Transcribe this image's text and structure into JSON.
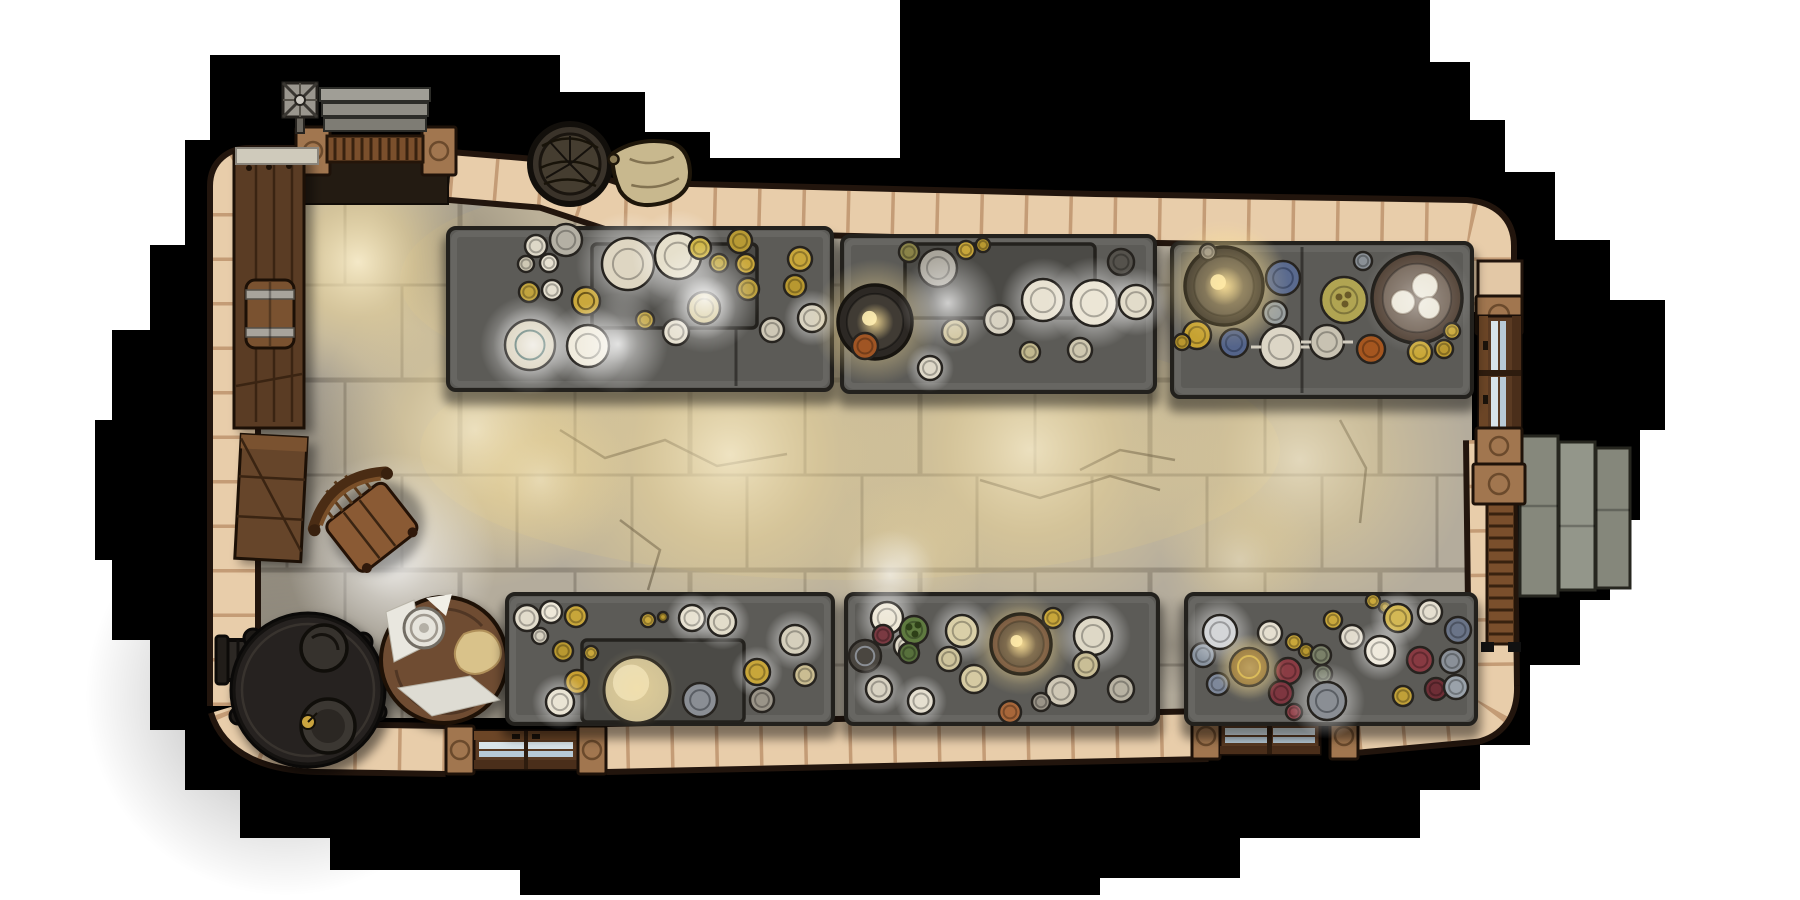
{
  "scene": {
    "description": "Top-down fantasy battle map of a stone feast hall kitchen: six laden stone banquet tables, iron stove, round prep table, barrels, crates, baskets, stone stairs and three doorways, surrounded by a black pixel-stepped void",
    "canvas": {
      "width": 1800,
      "height": 900,
      "background": "#ffffff"
    },
    "palette": {
      "void": "#000000",
      "wall": "#e8cdaa",
      "wall_outline": "#22150d",
      "wall_seam": "rgba(160,108,66,0.5)",
      "floor": "#b4ac9c",
      "table": "#5c5b57",
      "table_inner": "#4b4a46",
      "table_outline": "#23211d",
      "wood": "#7a4f2c",
      "metal": "#8a8c80"
    },
    "objects": [
      "banquet-table-nw",
      "banquet-table-n",
      "banquet-table-ne",
      "banquet-table-sw",
      "banquet-table-s",
      "banquet-table-se",
      "iron-stove",
      "round-prep-table",
      "wooden-chair",
      "wooden-crate",
      "barrel",
      "wall-shelf",
      "storage-basket",
      "grain-sack",
      "entrance-steps",
      "weather-vane",
      "right-door",
      "right-ladder",
      "right-platform",
      "bottom-door-west",
      "bottom-door-east"
    ]
  },
  "props": {
    "weather-vane": {
      "x": 300,
      "y": 100,
      "rot": 0
    },
    "entrance-steps": {
      "x": 375,
      "y": 110,
      "rot": 0
    },
    "storage-basket": {
      "x": 570,
      "y": 164,
      "rot": 0
    },
    "grain-sack": {
      "x": 652,
      "y": 174,
      "rot": -8
    },
    "wall-shelf": {
      "x": 269,
      "y": 288,
      "rot": 0
    },
    "barrel": {
      "x": 270,
      "y": 314,
      "rot": 0
    },
    "wooden-crate": {
      "x": 271,
      "y": 498,
      "rot": 3
    },
    "chair": {
      "x": 368,
      "y": 524,
      "rot": -38
    },
    "stove": {
      "x": 308,
      "y": 690,
      "rot": 0
    },
    "prep-table-round": {
      "x": 444,
      "y": 660,
      "rot": 0
    },
    "right-door": {
      "x": 1500,
      "y": 373,
      "rot": 0
    },
    "right-ladder": {
      "x": 1501,
      "y": 574,
      "rot": 0
    },
    "right-platform": {
      "x": 1575,
      "y": 516,
      "rot": 0
    },
    "bottom-door-west": {
      "x": 526,
      "y": 750,
      "rot": 0
    },
    "bottom-door-east": {
      "x": 1270,
      "y": 735,
      "rot": 0
    }
  },
  "lights": [
    {
      "x": 358,
      "y": 262,
      "r": 125,
      "kind": "warm",
      "o": 0.9,
      "layer": "floor"
    },
    {
      "x": 475,
      "y": 430,
      "r": 160,
      "kind": "warm",
      "o": 0.75,
      "layer": "floor"
    },
    {
      "x": 730,
      "y": 455,
      "r": 200,
      "kind": "warm",
      "o": 0.8,
      "layer": "floor"
    },
    {
      "x": 1030,
      "y": 450,
      "r": 190,
      "kind": "warm",
      "o": 0.75,
      "layer": "floor"
    },
    {
      "x": 1300,
      "y": 460,
      "r": 170,
      "kind": "warm",
      "o": 0.65,
      "layer": "floor"
    },
    {
      "x": 540,
      "y": 480,
      "r": 90,
      "kind": "warm",
      "o": 0.5,
      "layer": "floor"
    },
    {
      "x": 620,
      "y": 300,
      "r": 90,
      "kind": "white",
      "o": 0.5,
      "layer": "floor"
    },
    {
      "x": 905,
      "y": 560,
      "r": 80,
      "kind": "warm",
      "o": 0.45,
      "layer": "floor"
    },
    {
      "x": 1240,
      "y": 560,
      "r": 80,
      "kind": "warm",
      "o": 0.4,
      "layer": "floor"
    },
    {
      "x": 392,
      "y": 558,
      "r": 105,
      "kind": "white",
      "o": 0.85,
      "layer": "floor"
    },
    {
      "x": 705,
      "y": 298,
      "r": 55,
      "kind": "white",
      "o": 0.85,
      "layer": "top"
    },
    {
      "x": 948,
      "y": 303,
      "r": 50,
      "kind": "white",
      "o": 0.75,
      "layer": "top"
    },
    {
      "x": 618,
      "y": 344,
      "r": 50,
      "kind": "white",
      "o": 0.8,
      "layer": "top"
    },
    {
      "x": 533,
      "y": 345,
      "r": 40,
      "kind": "white",
      "o": 0.7,
      "layer": "top"
    },
    {
      "x": 890,
      "y": 575,
      "r": 45,
      "kind": "white",
      "o": 0.6,
      "layer": "top"
    },
    {
      "x": 1229,
      "y": 287,
      "r": 60,
      "kind": "gold",
      "o": 0.6,
      "layer": "top"
    },
    {
      "x": 1418,
      "y": 300,
      "r": 55,
      "kind": "white",
      "o": 0.45,
      "layer": "top"
    },
    {
      "x": 637,
      "y": 688,
      "r": 40,
      "kind": "gold",
      "o": 0.4,
      "layer": "top"
    },
    {
      "x": 1022,
      "y": 645,
      "r": 40,
      "kind": "gold",
      "o": 0.5,
      "layer": "top"
    },
    {
      "x": 1250,
      "y": 668,
      "r": 35,
      "kind": "gold",
      "o": 0.5,
      "layer": "top"
    }
  ],
  "darks": [
    {
      "x": 285,
      "y": 696,
      "r": 200,
      "o": 0.55
    },
    {
      "x": 262,
      "y": 470,
      "r": 150,
      "o": 0.4
    },
    {
      "x": 455,
      "y": 250,
      "r": 90,
      "o": 0.28
    },
    {
      "x": 520,
      "y": 700,
      "r": 80,
      "o": 0.35
    },
    {
      "x": 840,
      "y": 300,
      "r": 55,
      "o": 0.3
    },
    {
      "x": 1165,
      "y": 312,
      "r": 55,
      "o": 0.3
    },
    {
      "x": 1172,
      "y": 645,
      "r": 50,
      "o": 0.3
    }
  ],
  "tables": [
    {
      "id": "banquet-table-nw",
      "x": 448,
      "y": 228,
      "w": 384,
      "h": 162,
      "inner": {
        "x": 592,
        "y": 244,
        "w": 165,
        "h": 84
      },
      "seam": 736,
      "dishes": [
        {
          "x": 536,
          "y": 246,
          "r": 11,
          "f": "#ded8c8"
        },
        {
          "x": 549,
          "y": 263,
          "r": 9,
          "f": "#e8e2d2"
        },
        {
          "x": 526,
          "y": 264,
          "r": 8,
          "f": "#cfc8b4"
        },
        {
          "x": 566,
          "y": 240,
          "r": 16,
          "f": "#b4b0a4"
        },
        {
          "x": 529,
          "y": 292,
          "r": 10,
          "f": "#c2a43e"
        },
        {
          "x": 552,
          "y": 290,
          "r": 10,
          "f": "#e5dfcf"
        },
        {
          "x": 586,
          "y": 301,
          "r": 14,
          "f": "#caa83c",
          "ring": "#6b5618"
        },
        {
          "x": 628,
          "y": 264,
          "r": 26,
          "f": "#ded6c2",
          "glow": 1
        },
        {
          "x": 678,
          "y": 256,
          "r": 23,
          "f": "#e6e0cc",
          "glow": 1
        },
        {
          "x": 530,
          "y": 345,
          "r": 25,
          "f": "#d8d0ba",
          "glow": 1,
          "ring": "#4a6a62"
        },
        {
          "x": 588,
          "y": 346,
          "r": 21,
          "f": "#efeadb",
          "glow": 1
        },
        {
          "x": 645,
          "y": 320,
          "r": 9,
          "f": "#bfa038"
        },
        {
          "x": 676,
          "y": 332,
          "r": 13,
          "f": "#e6e0d0"
        },
        {
          "x": 704,
          "y": 308,
          "r": 16,
          "f": "#cfc089",
          "glow": 1
        },
        {
          "x": 700,
          "y": 248,
          "r": 11,
          "f": "#d2b84a"
        },
        {
          "x": 719,
          "y": 263,
          "r": 9,
          "f": "#c2a83e"
        },
        {
          "x": 740,
          "y": 241,
          "r": 12,
          "f": "#b89a34"
        },
        {
          "x": 746,
          "y": 264,
          "r": 10,
          "f": "#caa83c"
        },
        {
          "x": 748,
          "y": 289,
          "r": 11,
          "f": "#b89a34"
        },
        {
          "x": 800,
          "y": 259,
          "r": 12,
          "f": "#c8a63a"
        },
        {
          "x": 795,
          "y": 286,
          "r": 11,
          "f": "#b89830"
        },
        {
          "x": 812,
          "y": 318,
          "r": 14,
          "f": "#d8d2c0",
          "glow": 1
        },
        {
          "x": 772,
          "y": 330,
          "r": 12,
          "f": "#cfc8b6"
        }
      ]
    },
    {
      "id": "banquet-table-n",
      "x": 842,
      "y": 236,
      "w": 313,
      "h": 156,
      "inner": {
        "x": 905,
        "y": 244,
        "w": 190,
        "h": 74
      },
      "dishes": [
        {
          "x": 938,
          "y": 268,
          "r": 19,
          "f": "#a8a49a"
        },
        {
          "x": 875,
          "y": 322,
          "r": 37,
          "k": "bowl",
          "f": "#403b34",
          "rim": "#2c2824",
          "gw": 1
        },
        {
          "x": 909,
          "y": 252,
          "r": 10,
          "f": "#8a8348"
        },
        {
          "x": 966,
          "y": 250,
          "r": 9,
          "f": "#c8a63a"
        },
        {
          "x": 983,
          "y": 245,
          "r": 7,
          "f": "#b89830"
        },
        {
          "x": 1043,
          "y": 300,
          "r": 21,
          "f": "#e8e2d2",
          "glow": 1
        },
        {
          "x": 1094,
          "y": 303,
          "r": 23,
          "f": "#ece6d6",
          "glow": 1
        },
        {
          "x": 999,
          "y": 320,
          "r": 15,
          "f": "#d8d2c2"
        },
        {
          "x": 955,
          "y": 332,
          "r": 13,
          "f": "#cabd92"
        },
        {
          "x": 1121,
          "y": 262,
          "r": 13,
          "f": "#55524c"
        },
        {
          "x": 1136,
          "y": 302,
          "r": 17,
          "f": "#e2dcca",
          "glow": 1
        },
        {
          "x": 865,
          "y": 346,
          "r": 13,
          "f": "#a05524"
        },
        {
          "x": 930,
          "y": 368,
          "r": 12,
          "f": "#ded8c8",
          "glow": 1
        },
        {
          "x": 1030,
          "y": 352,
          "r": 10,
          "f": "#c2b88e"
        },
        {
          "x": 1080,
          "y": 350,
          "r": 12,
          "f": "#cfc8b0"
        }
      ]
    },
    {
      "id": "banquet-table-ne",
      "x": 1172,
      "y": 243,
      "w": 300,
      "h": 154,
      "seam": 1302,
      "dishes": [
        {
          "x": 1224,
          "y": 286,
          "r": 39,
          "k": "bowl",
          "f": "#4a443c",
          "rim": "#332e28",
          "gw": 1
        },
        {
          "x": 1417,
          "y": 298,
          "r": 45,
          "k": "bowl",
          "f": "#6a5a4c",
          "rim": "#4a392c",
          "buns": 1
        },
        {
          "x": 1283,
          "y": 278,
          "r": 17,
          "f": "#5a6a8e",
          "ring": "#3c4a6a"
        },
        {
          "x": 1234,
          "y": 343,
          "r": 14,
          "f": "#54648a",
          "ring": "#3c4a6a"
        },
        {
          "x": 1275,
          "y": 313,
          "r": 12,
          "f": "#9aa0a0"
        },
        {
          "x": 1363,
          "y": 261,
          "r": 9,
          "f": "#8a9096"
        },
        {
          "x": 1344,
          "y": 300,
          "r": 23,
          "f": "#b0a452",
          "dots": "#6a5a28"
        },
        {
          "x": 1281,
          "y": 347,
          "r": 21,
          "f": "#dcd6c6",
          "cut": 1
        },
        {
          "x": 1327,
          "y": 342,
          "r": 17,
          "f": "#c8c2b2",
          "cut": 1
        },
        {
          "x": 1371,
          "y": 349,
          "r": 14,
          "f": "#a5561f"
        },
        {
          "x": 1197,
          "y": 335,
          "r": 14,
          "f": "#c6a232"
        },
        {
          "x": 1182,
          "y": 342,
          "r": 8,
          "f": "#b8962e"
        },
        {
          "x": 1420,
          "y": 352,
          "r": 12,
          "f": "#caa838"
        },
        {
          "x": 1444,
          "y": 349,
          "r": 9,
          "f": "#ba9830"
        },
        {
          "x": 1452,
          "y": 331,
          "r": 8,
          "f": "#caa838"
        },
        {
          "x": 1208,
          "y": 252,
          "r": 8,
          "f": "#9a9488"
        }
      ]
    },
    {
      "id": "banquet-table-sw",
      "x": 507,
      "y": 594,
      "w": 326,
      "h": 130,
      "inner": {
        "x": 582,
        "y": 640,
        "w": 162,
        "h": 82
      },
      "dishes": [
        {
          "x": 527,
          "y": 618,
          "r": 13,
          "f": "#e2dccc"
        },
        {
          "x": 551,
          "y": 612,
          "r": 11,
          "f": "#eee8d8"
        },
        {
          "x": 540,
          "y": 636,
          "r": 8,
          "f": "#d8d2c2"
        },
        {
          "x": 576,
          "y": 616,
          "r": 11,
          "f": "#c8a63a"
        },
        {
          "x": 563,
          "y": 651,
          "r": 10,
          "f": "#b89830"
        },
        {
          "x": 591,
          "y": 653,
          "r": 7,
          "f": "#caa83c"
        },
        {
          "x": 577,
          "y": 682,
          "r": 12,
          "f": "#c8a032"
        },
        {
          "x": 560,
          "y": 702,
          "r": 14,
          "f": "#eae4d4",
          "glow": 1
        },
        {
          "x": 648,
          "y": 620,
          "r": 7,
          "f": "#caa83c"
        },
        {
          "x": 663,
          "y": 617,
          "r": 5,
          "f": "#b89830"
        },
        {
          "x": 692,
          "y": 618,
          "r": 13,
          "f": "#e8e2d2",
          "glow": 1
        },
        {
          "x": 722,
          "y": 622,
          "r": 14,
          "f": "#e2dcca",
          "glow": 1
        },
        {
          "x": 637,
          "y": 690,
          "r": 33,
          "k": "dome",
          "f": "#cdbf96"
        },
        {
          "x": 700,
          "y": 700,
          "r": 17,
          "f": "#8a8e94",
          "ring": "#5a5e64"
        },
        {
          "x": 757,
          "y": 672,
          "r": 13,
          "f": "#c8a63a",
          "glow": 1
        },
        {
          "x": 762,
          "y": 700,
          "r": 12,
          "f": "#9a9488"
        },
        {
          "x": 795,
          "y": 640,
          "r": 15,
          "f": "#d5cfbc",
          "glow": 1
        },
        {
          "x": 805,
          "y": 675,
          "r": 11,
          "f": "#cabd92"
        }
      ]
    },
    {
      "id": "banquet-table-s",
      "x": 846,
      "y": 594,
      "w": 312,
      "h": 130,
      "dishes": [
        {
          "x": 887,
          "y": 618,
          "r": 16,
          "f": "#eee8d8",
          "glow": 1
        },
        {
          "x": 906,
          "y": 646,
          "r": 12,
          "f": "#ded8c8"
        },
        {
          "x": 865,
          "y": 656,
          "r": 16,
          "f": "#4a4640",
          "ring": "#8a8e94"
        },
        {
          "x": 879,
          "y": 689,
          "r": 13,
          "f": "#d8d2c2",
          "glow": 1
        },
        {
          "x": 883,
          "y": 635,
          "r": 10,
          "f": "#7a3a42"
        },
        {
          "x": 914,
          "y": 630,
          "r": 14,
          "f": "#5f7a40",
          "dots": "#2e4018"
        },
        {
          "x": 909,
          "y": 653,
          "r": 10,
          "f": "#57703c"
        },
        {
          "x": 962,
          "y": 631,
          "r": 16,
          "f": "#d9cfa8",
          "glow": 1
        },
        {
          "x": 949,
          "y": 659,
          "r": 12,
          "f": "#cfc49c"
        },
        {
          "x": 974,
          "y": 679,
          "r": 14,
          "f": "#d5caa2"
        },
        {
          "x": 921,
          "y": 701,
          "r": 13,
          "f": "#e5dfd0",
          "glow": 1
        },
        {
          "x": 1021,
          "y": 644,
          "r": 30,
          "k": "bowl",
          "f": "#4f3f32",
          "rim": "#6a4a36",
          "gw": 1
        },
        {
          "x": 1053,
          "y": 618,
          "r": 10,
          "f": "#c8a63a"
        },
        {
          "x": 1093,
          "y": 636,
          "r": 19,
          "f": "#ded8c6",
          "glow": 1
        },
        {
          "x": 1086,
          "y": 665,
          "r": 13,
          "f": "#c9be96"
        },
        {
          "x": 1121,
          "y": 689,
          "r": 13,
          "f": "#b8b2a2"
        },
        {
          "x": 1061,
          "y": 691,
          "r": 15,
          "f": "#cfc8b6"
        },
        {
          "x": 1041,
          "y": 702,
          "r": 9,
          "f": "#9a9488"
        },
        {
          "x": 1010,
          "y": 712,
          "r": 11,
          "f": "#a8673a"
        }
      ]
    },
    {
      "id": "banquet-table-se",
      "x": 1186,
      "y": 594,
      "w": 290,
      "h": 130,
      "dishes": [
        {
          "x": 1203,
          "y": 655,
          "r": 12,
          "f": "#8a94a0"
        },
        {
          "x": 1218,
          "y": 684,
          "r": 11,
          "f": "#7e889a"
        },
        {
          "x": 1220,
          "y": 632,
          "r": 17,
          "f": "#d4d6d8",
          "glow": 1
        },
        {
          "x": 1270,
          "y": 633,
          "r": 12,
          "f": "#e5dfd0"
        },
        {
          "x": 1294,
          "y": 642,
          "r": 8,
          "f": "#c8a63a"
        },
        {
          "x": 1306,
          "y": 651,
          "r": 7,
          "f": "#b89830"
        },
        {
          "x": 1321,
          "y": 655,
          "r": 10,
          "f": "#7a8068"
        },
        {
          "x": 1323,
          "y": 674,
          "r": 9,
          "f": "#6e7460"
        },
        {
          "x": 1288,
          "y": 671,
          "r": 13,
          "f": "#8a3c44"
        },
        {
          "x": 1281,
          "y": 693,
          "r": 12,
          "f": "#7e3640"
        },
        {
          "x": 1294,
          "y": 712,
          "r": 8,
          "f": "#93444c"
        },
        {
          "x": 1249,
          "y": 667,
          "r": 19,
          "f": "#8a6a30",
          "ring": "#caa83c",
          "gw": 1
        },
        {
          "x": 1327,
          "y": 701,
          "r": 19,
          "f": "#8a8e94",
          "ring": "#5a5e64",
          "glow": 1
        },
        {
          "x": 1333,
          "y": 620,
          "r": 9,
          "f": "#caa83c"
        },
        {
          "x": 1352,
          "y": 637,
          "r": 12,
          "f": "#e2dcce"
        },
        {
          "x": 1373,
          "y": 601,
          "r": 7,
          "f": "#caa83c"
        },
        {
          "x": 1385,
          "y": 607,
          "r": 6,
          "f": "#b89830"
        },
        {
          "x": 1398,
          "y": 618,
          "r": 14,
          "f": "#d3b855",
          "glow": 1
        },
        {
          "x": 1430,
          "y": 612,
          "r": 12,
          "f": "#e5dfd0"
        },
        {
          "x": 1458,
          "y": 630,
          "r": 13,
          "f": "#6a7488"
        },
        {
          "x": 1420,
          "y": 660,
          "r": 13,
          "f": "#883a42"
        },
        {
          "x": 1452,
          "y": 661,
          "r": 12,
          "f": "#8a9098"
        },
        {
          "x": 1436,
          "y": 689,
          "r": 11,
          "f": "#6e2e36"
        },
        {
          "x": 1456,
          "y": 687,
          "r": 12,
          "f": "#9aa2aa"
        },
        {
          "x": 1403,
          "y": 696,
          "r": 10,
          "f": "#c0a038"
        },
        {
          "x": 1380,
          "y": 651,
          "r": 15,
          "f": "#efeadd",
          "glow": 1
        }
      ]
    }
  ]
}
